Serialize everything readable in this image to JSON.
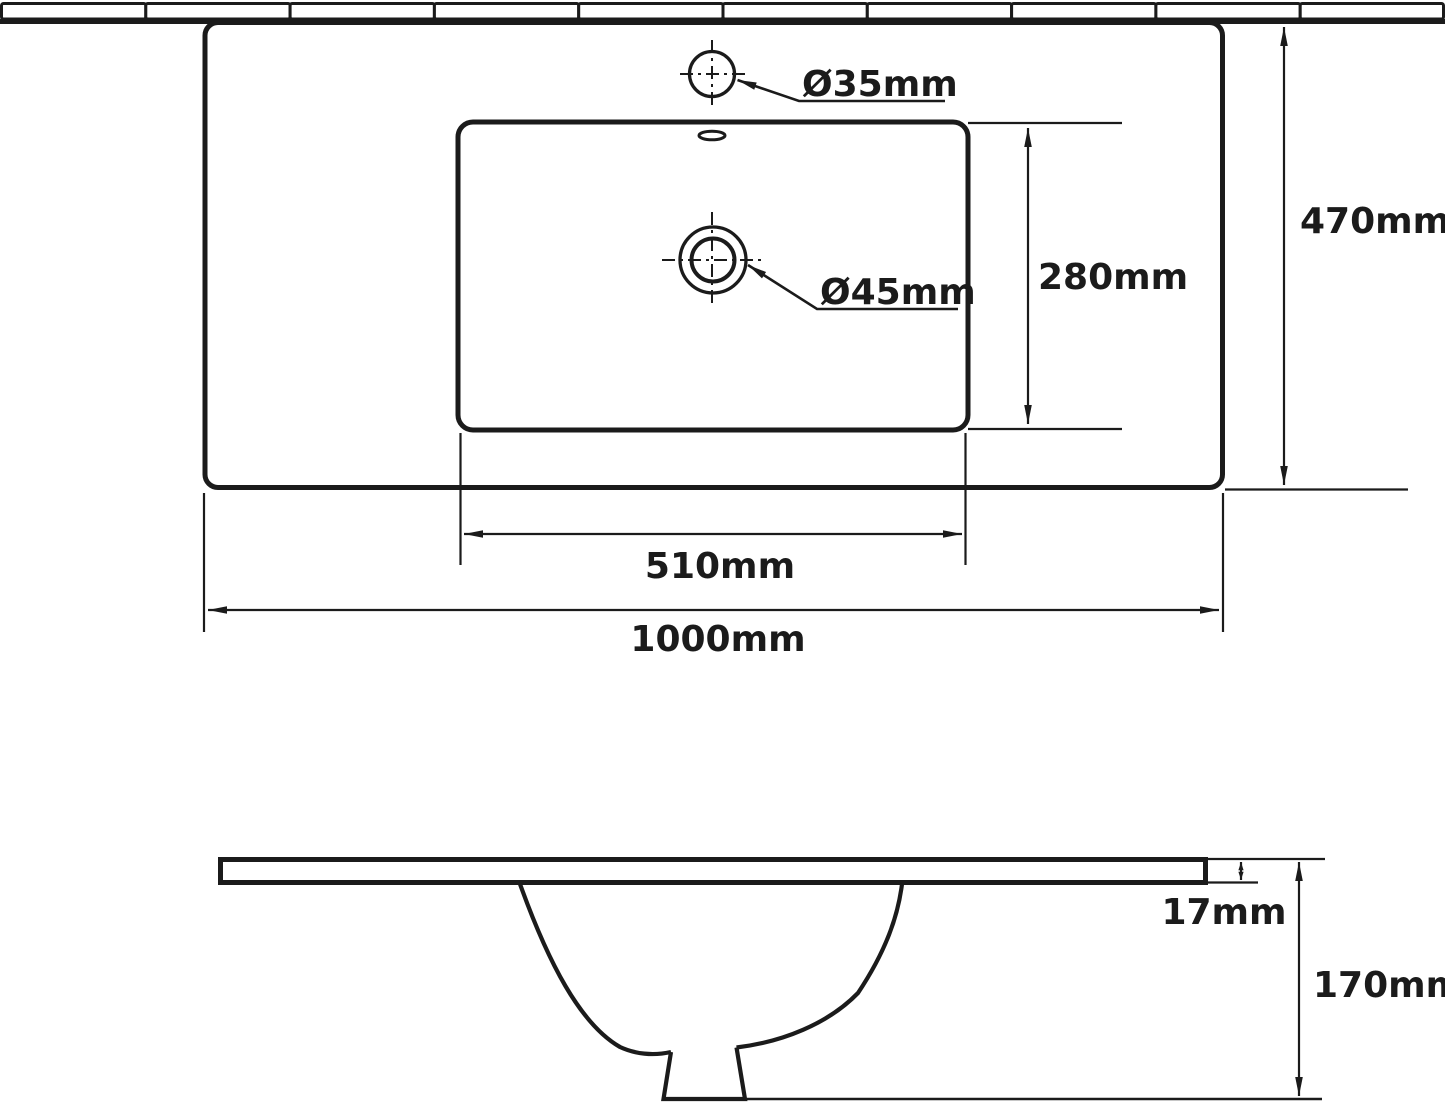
{
  "drawing": {
    "kind": "washbasin technical dimension drawing",
    "colors": {
      "line": "#1b1b1b",
      "background": "#ffffff"
    },
    "top_view": {
      "faucet_hole_diameter": "Ø35mm",
      "drain_hole_diameter": "Ø45mm",
      "bowl_depth": "280mm",
      "basin_depth": "470mm",
      "bowl_width": "510mm",
      "basin_width": "1000mm"
    },
    "side_view": {
      "rim_thickness": "17mm",
      "overall_height": "170mm"
    }
  }
}
